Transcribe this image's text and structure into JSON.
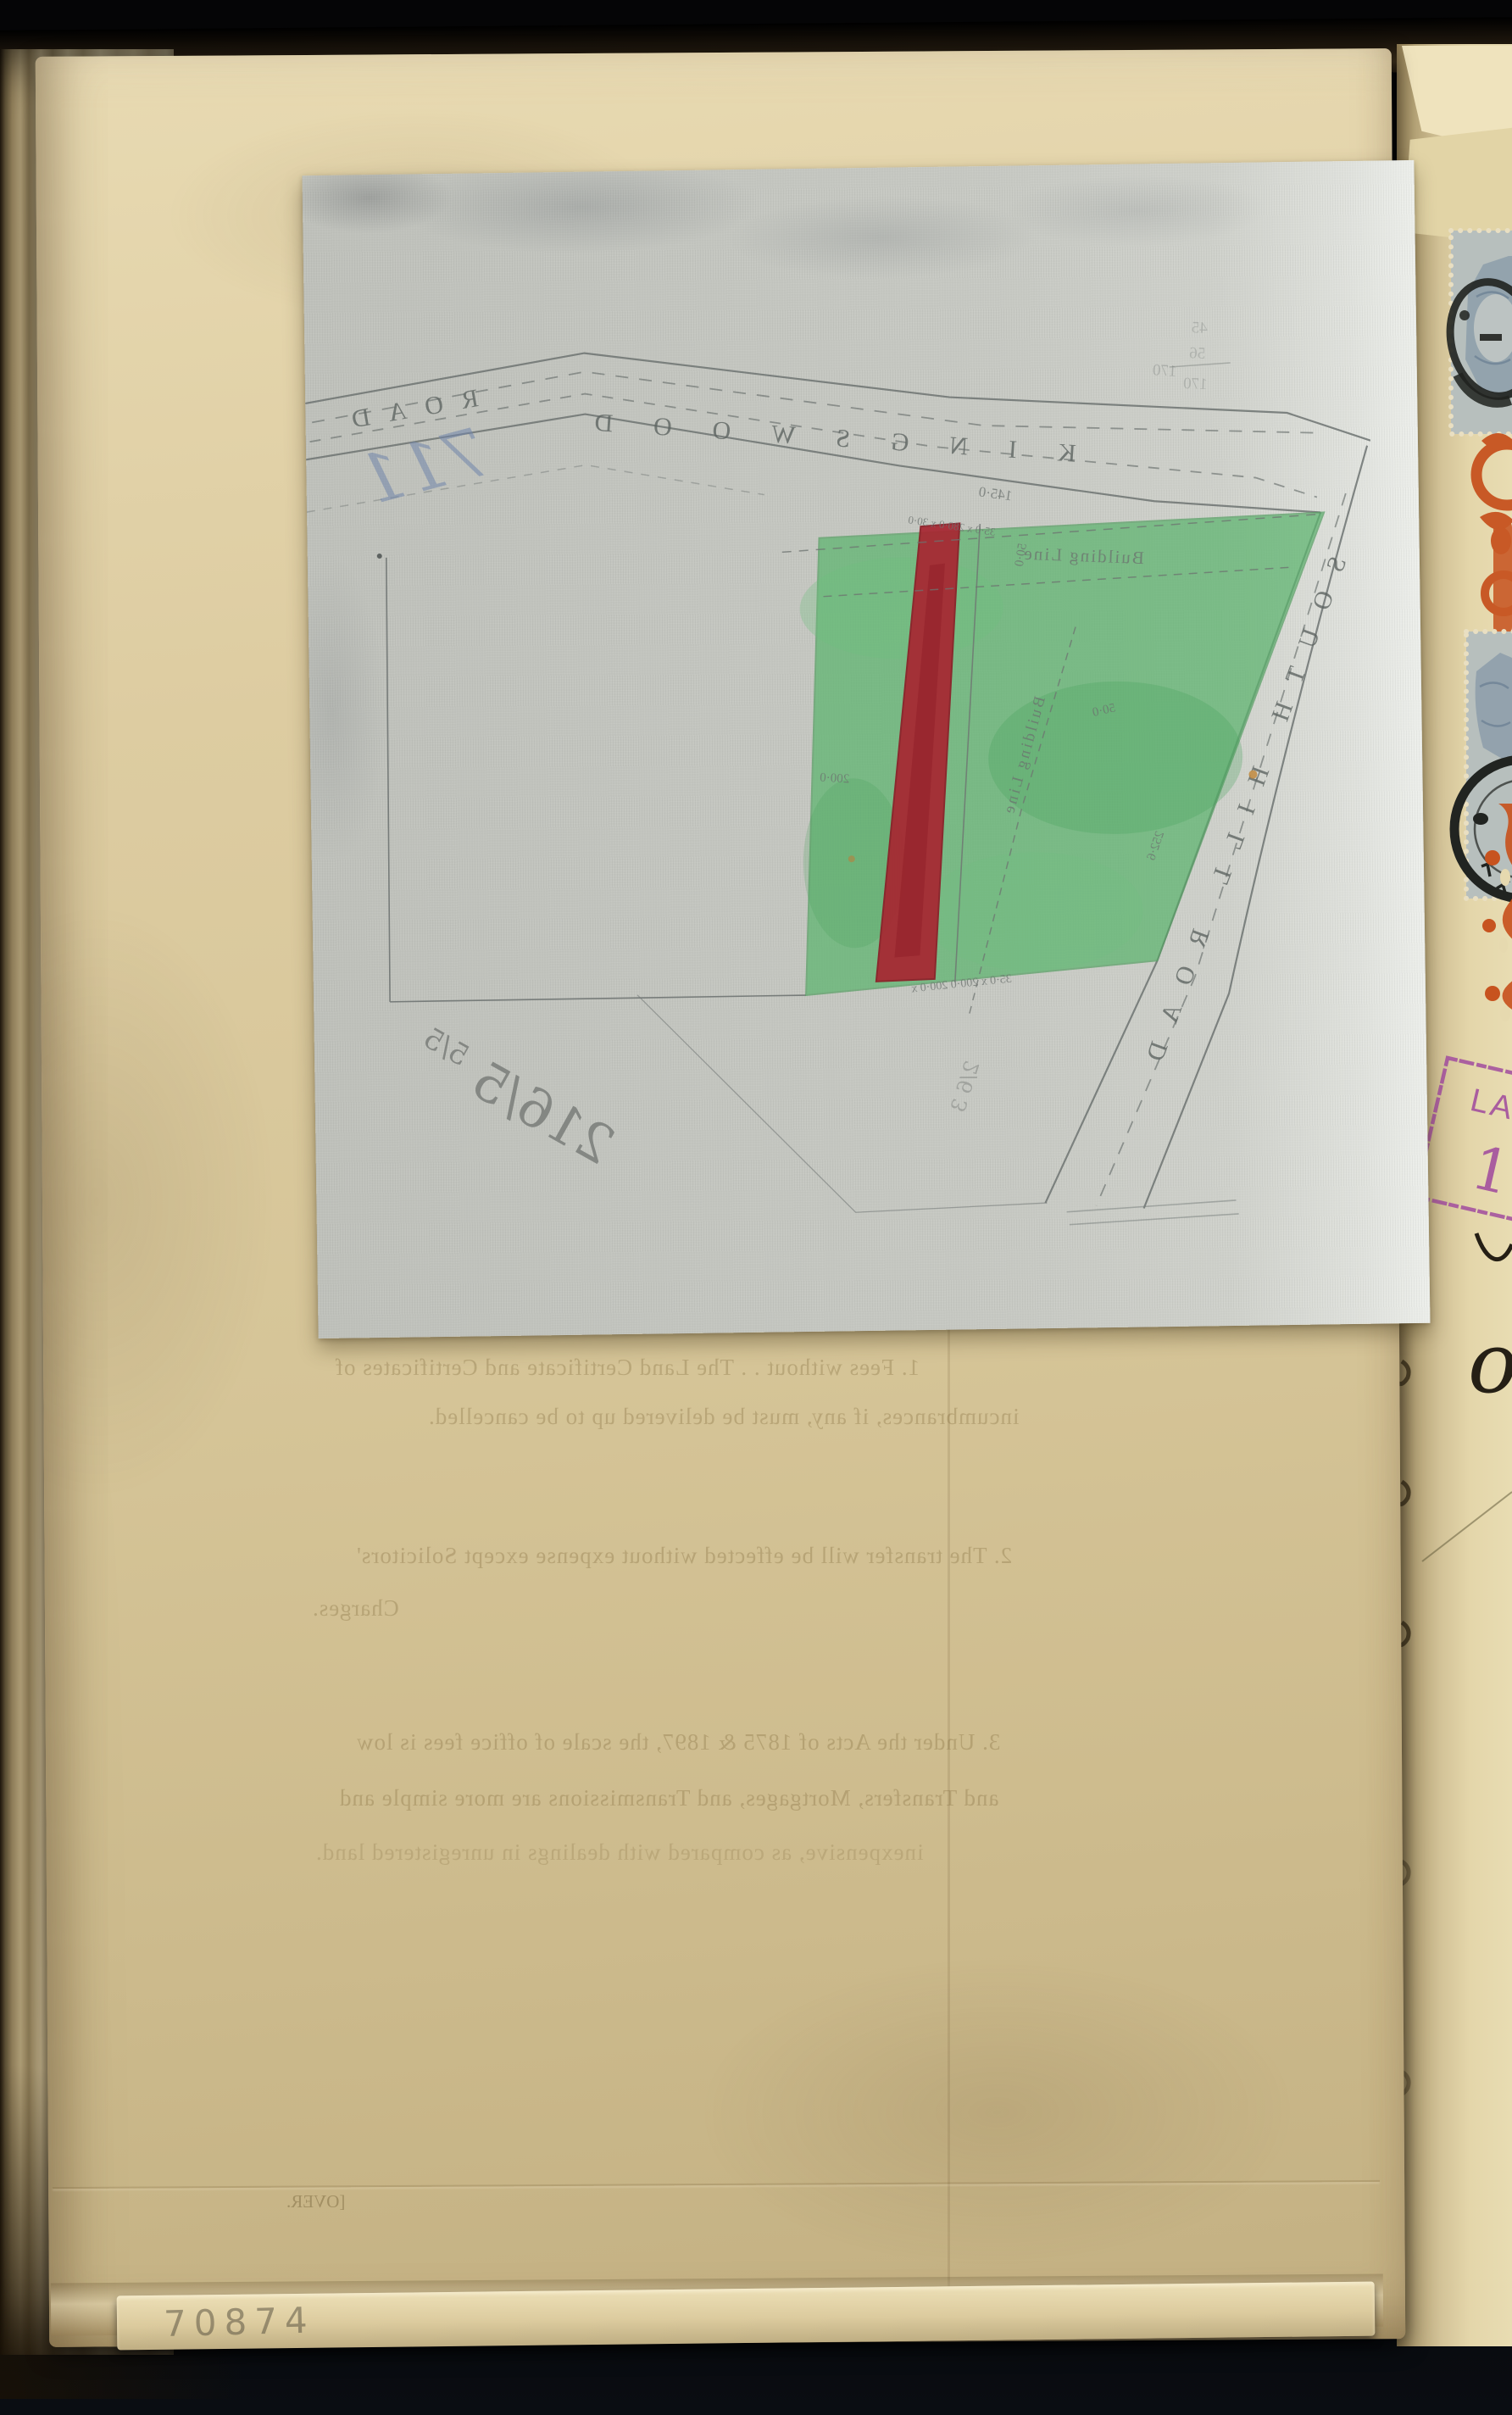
{
  "map": {
    "kingswood": {
      "name": "KINGSWOOD ROAD",
      "part1": "KINGSWOOD",
      "part2": "ROAD"
    },
    "south_hill": {
      "name": "SOUTH HILL ROAD"
    },
    "building_line_1": "Building Line",
    "building_line_2": "Building Line",
    "measurements": [
      {
        "t": "145·0"
      },
      {
        "t": "35·0 x 280·0 x 30·0"
      },
      {
        "t": "50·0"
      },
      {
        "t": "50·0"
      },
      {
        "t": "200·0"
      },
      {
        "t": "252·6"
      },
      {
        "t": "35·0 x 200·0   200·0 x"
      },
      {
        "t": "170"
      },
      {
        "t": "45"
      },
      {
        "t": "56"
      },
      {
        "t": "170"
      }
    ],
    "handwriting": {
      "large": "216/5",
      "small": "5/5",
      "mid": "2/6 3",
      "blue": "711"
    },
    "colors": {
      "plot_green": "#5cb46e",
      "plot_red": "#a72631",
      "linen": "#c7c9c3"
    }
  },
  "show_through": {
    "p1l1": "1. Fees without . .  The Land Certificate and Certificates of",
    "p1l2": "incumbrances, if any, must be delivered up to be cancelled.",
    "p2l1": "2. The transfer will be effected without expense except Solicitors'",
    "p2l2": "Charges.",
    "p3l1": "3. Under the Acts of 1875 & 1897, the scale of office fees is low",
    "p3l2": "and Transfers, Mortgages, and Transmissions are more simple and",
    "p3l3": "inexpensive, as compared with dealings in unregistered land."
  },
  "edge": {
    "over": "[OVER.",
    "folio": "70874"
  },
  "facing": {
    "stamp_line": "LAN",
    "stamp_numeral": "1",
    "ink_word": "of",
    "colors": {
      "stamp_blue": "#8fa0ab",
      "stamp_orange": "#c7531f",
      "stamp_purple": "#a4539e",
      "cancel_black": "#212421"
    }
  }
}
